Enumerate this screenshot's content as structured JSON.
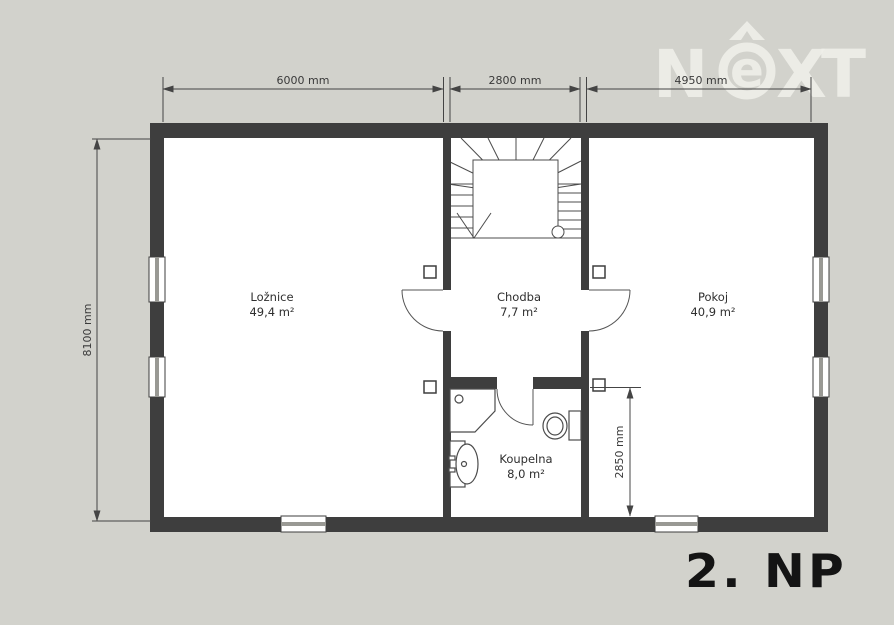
{
  "floor": {
    "label": "2. NP"
  },
  "logo": {
    "n": "N",
    "e": "e",
    "x": "X",
    "t": "T"
  },
  "rooms": [
    {
      "id": "loznice",
      "name": "Ložnice",
      "area": "49,4 m²"
    },
    {
      "id": "chodba",
      "name": "Chodba",
      "area": "7,7 m²"
    },
    {
      "id": "pokoj",
      "name": "Pokoj",
      "area": "40,9 m²"
    },
    {
      "id": "koupelna",
      "name": "Koupelna",
      "area": "8,0 m²"
    }
  ],
  "dimensions": {
    "top": [
      "6000 mm",
      "2800 mm",
      "4950 mm"
    ],
    "left": "8100 mm",
    "interior": "2850 mm"
  },
  "colors": {
    "background": "#d2d2cc",
    "wall": "#3e3e3e",
    "floor": "#ffffff",
    "line": "#4c4c4c",
    "dimension": "#444444",
    "glazing": "#999994",
    "text": "#2f2f2f",
    "logo": "#efefe9"
  }
}
